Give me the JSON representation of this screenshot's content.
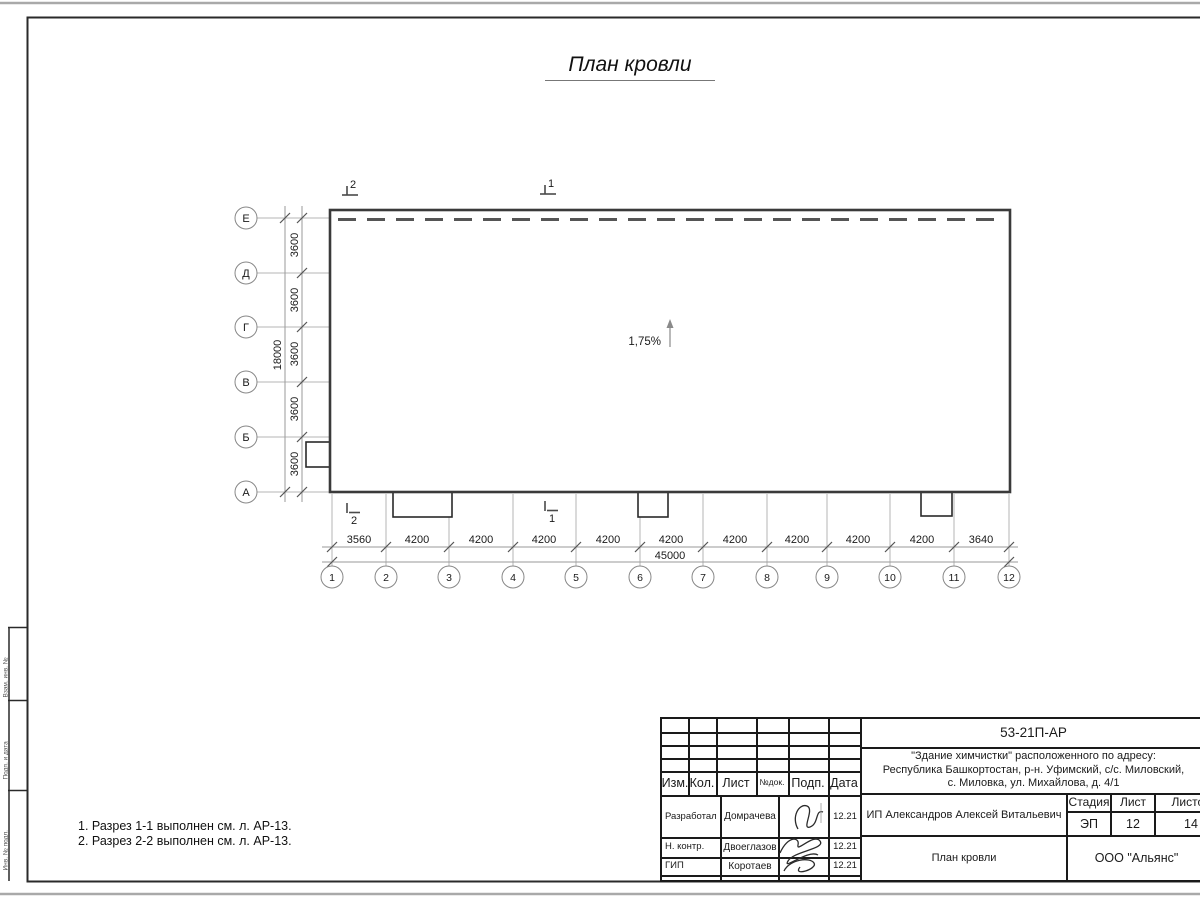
{
  "page": {
    "title": "План кровли"
  },
  "notes": {
    "line1": "1. Разрез 1-1 выполнен см. л. АР-13.",
    "line2": "2. Разрез 2-2 выполнен см. л. АР-13."
  },
  "plan": {
    "slope": "1,75%",
    "row_axes": [
      "Е",
      "Д",
      "Г",
      "В",
      "Б",
      "А"
    ],
    "row_dims": [
      "3600",
      "3600",
      "3600",
      "3600",
      "3600"
    ],
    "row_total": "18000",
    "col_axes": [
      "1",
      "2",
      "3",
      "4",
      "5",
      "6",
      "7",
      "8",
      "9",
      "10",
      "11",
      "12"
    ],
    "col_dims": [
      "3560",
      "4200",
      "4200",
      "4200",
      "4200",
      "4200",
      "4200",
      "4200",
      "4200",
      "4200",
      "3640"
    ],
    "col_total": "45000",
    "sections": {
      "top_2": "2",
      "top_1": "1",
      "bottom_2": "2",
      "bottom_1": "1"
    }
  },
  "titleblock": {
    "doc_number": "53-21П-АР",
    "address_line1": "\"Здание химчистки\" расположенного по адресу:",
    "address_line2": "Республика Башкортостан, р-н. Уфимский, с/с. Миловский,",
    "address_line3": "с. Миловка, ул. Михайлова, д. 4/1",
    "client": "ИП Александров Алексей Витальевич",
    "drawing_title": "План кровли",
    "company": "ООО \"Альянс\"",
    "stage_label": "Стадия",
    "sheet_label": "Лист",
    "sheets_label": "Листов",
    "stage": "ЭП",
    "sheet_num": "12",
    "sheets_total": "14",
    "cols": {
      "izm": "Изм.",
      "kol": "Кол.",
      "list": "Лист",
      "ndok": "№док.",
      "podp": "Подп.",
      "data": "Дата"
    },
    "rows": {
      "r1_role": "Разработал",
      "r1_name": "Домрачева",
      "r1_date": "12.21",
      "r2_role": "Н. контр.",
      "r2_name": "Двоеглазов",
      "r2_date": "12.21",
      "r3_role": "ГИП",
      "r3_name": "Коротаев",
      "r3_date": "12.21"
    }
  },
  "side_stamp": {
    "cell1": "Взам. инв. №",
    "cell2": "Подп. и дата",
    "cell3": "Инв. № подл."
  }
}
